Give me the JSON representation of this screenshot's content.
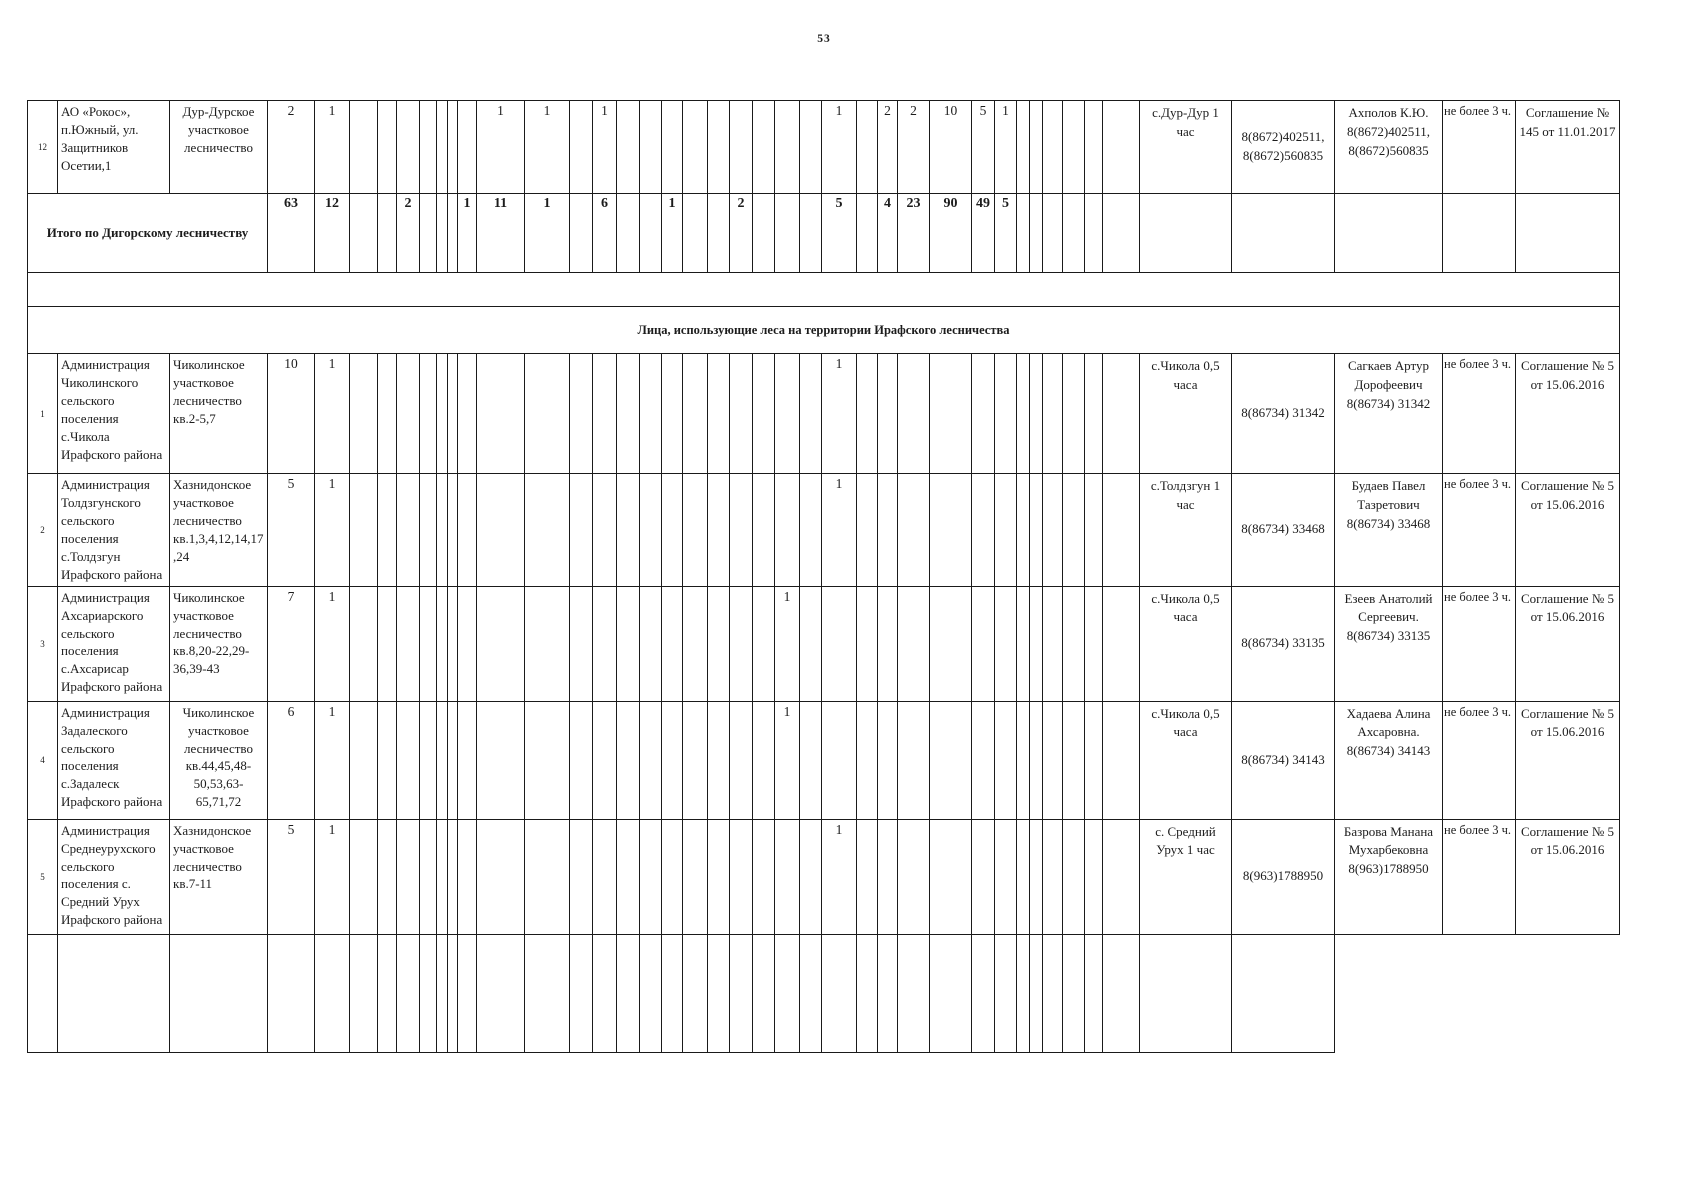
{
  "page": {
    "number": "53"
  },
  "colors": {
    "ink": "#1a1a1a",
    "paper": "#ffffff"
  },
  "table": {
    "section_header": "Лица, использующие леса на территории Ирафского лесничества",
    "summary": {
      "label": "Итого по Дигорскому лесничеству",
      "values": {
        "1": "63",
        "2": "12",
        "5": "2",
        "9": "1",
        "10": "11",
        "11": "1",
        "13": "6",
        "16": "1",
        "19": "2",
        "23": "5",
        "25": "4",
        "26": "23",
        "27": "90",
        "28": "49",
        "29": "5"
      }
    },
    "rows": [
      {
        "num": "12",
        "org": "АО «Рокос», п.Южный, ул. Защитников Осетии,1",
        "forestry": "Дур-Дурское участковое лесничество",
        "values": {
          "1": "2",
          "2": "1",
          "10": "1",
          "11": "1",
          "13": "1",
          "23": "1",
          "25": "2",
          "26": "2",
          "27": "10",
          "28": "5",
          "29": "1"
        },
        "place": "с.Дур-Дур 1 час",
        "phone": "8(8672)402511, 8(8672)560835",
        "contact": "Ахполов К.Ю. 8(8672)402511, 8(8672)560835",
        "limit": "не более 3 ч.",
        "agreement": "Соглашение № 145 от 11.01.2017"
      },
      {
        "num": "1",
        "org": "Администрация Чиколинского сельского поселения с.Чикола Ирафского района",
        "forestry": "Чиколинское участковое лесничество кв.2-5,7",
        "values": {
          "1": "10",
          "2": "1",
          "23": "1"
        },
        "place": "с.Чикола 0,5 часа",
        "phone": "8(86734) 31342",
        "contact": "Сагкаев Артур Дорофеевич 8(86734) 31342",
        "limit": "не более 3 ч.",
        "agreement": "Соглашение № 5 от 15.06.2016"
      },
      {
        "num": "2",
        "org": "Администрация Толдзгунского сельского поселения с.Толдзгун Ирафского района",
        "forestry": "Хазнидонское участковое лесничество кв.1,3,4,12,14,17,24",
        "values": {
          "1": "5",
          "2": "1",
          "23": "1"
        },
        "place": "с.Толдзгун 1 час",
        "phone": "8(86734) 33468",
        "contact": "Будаев Павел Тазретович 8(86734) 33468",
        "limit": "не более 3 ч.",
        "agreement": "Соглашение № 5 от 15.06.2016"
      },
      {
        "num": "3",
        "org": "Администрация Ахсариарского сельского поселения с.Ахсарисар Ирафского района",
        "forestry": "Чиколинское участковое лесничество кв.8,20-22,29-36,39-43",
        "values": {
          "1": "7",
          "2": "1",
          "21": "1"
        },
        "place": "с.Чикола 0,5 часа",
        "phone": "8(86734) 33135",
        "contact": "Езеев Анатолий Сергеевич. 8(86734) 33135",
        "limit": "не более 3 ч.",
        "agreement": "Соглашение № 5 от 15.06.2016"
      },
      {
        "num": "4",
        "org": "Администрация Задалеского сельского поселения с.Задалеск Ирафского района",
        "forestry": "Чиколинское участковое лесничество кв.44,45,48-50,53,63-65,71,72",
        "values": {
          "1": "6",
          "2": "1",
          "21": "1"
        },
        "place": "с.Чикола 0,5 часа",
        "phone": "8(86734) 34143",
        "contact": "Хадаева Алина Ахсаровна. 8(86734) 34143",
        "limit": "не более 3 ч.",
        "agreement": "Соглашение № 5 от 15.06.2016"
      },
      {
        "num": "5",
        "org": "Администрация Среднеурухского сельского поселения с. Средний Урух Ирафского района",
        "forestry": "Хазнидонское участковое лесничество кв.7-11",
        "values": {
          "1": "5",
          "2": "1",
          "23": "1"
        },
        "place": "с. Средний Урух  1 час",
        "phone": "8(963)1788950",
        "contact": "Базрова Манана Мухарбековна 8(963)1788950",
        "limit": "не более 3 ч.",
        "agreement": "Соглашение № 5 от 15.06.2016"
      }
    ]
  }
}
